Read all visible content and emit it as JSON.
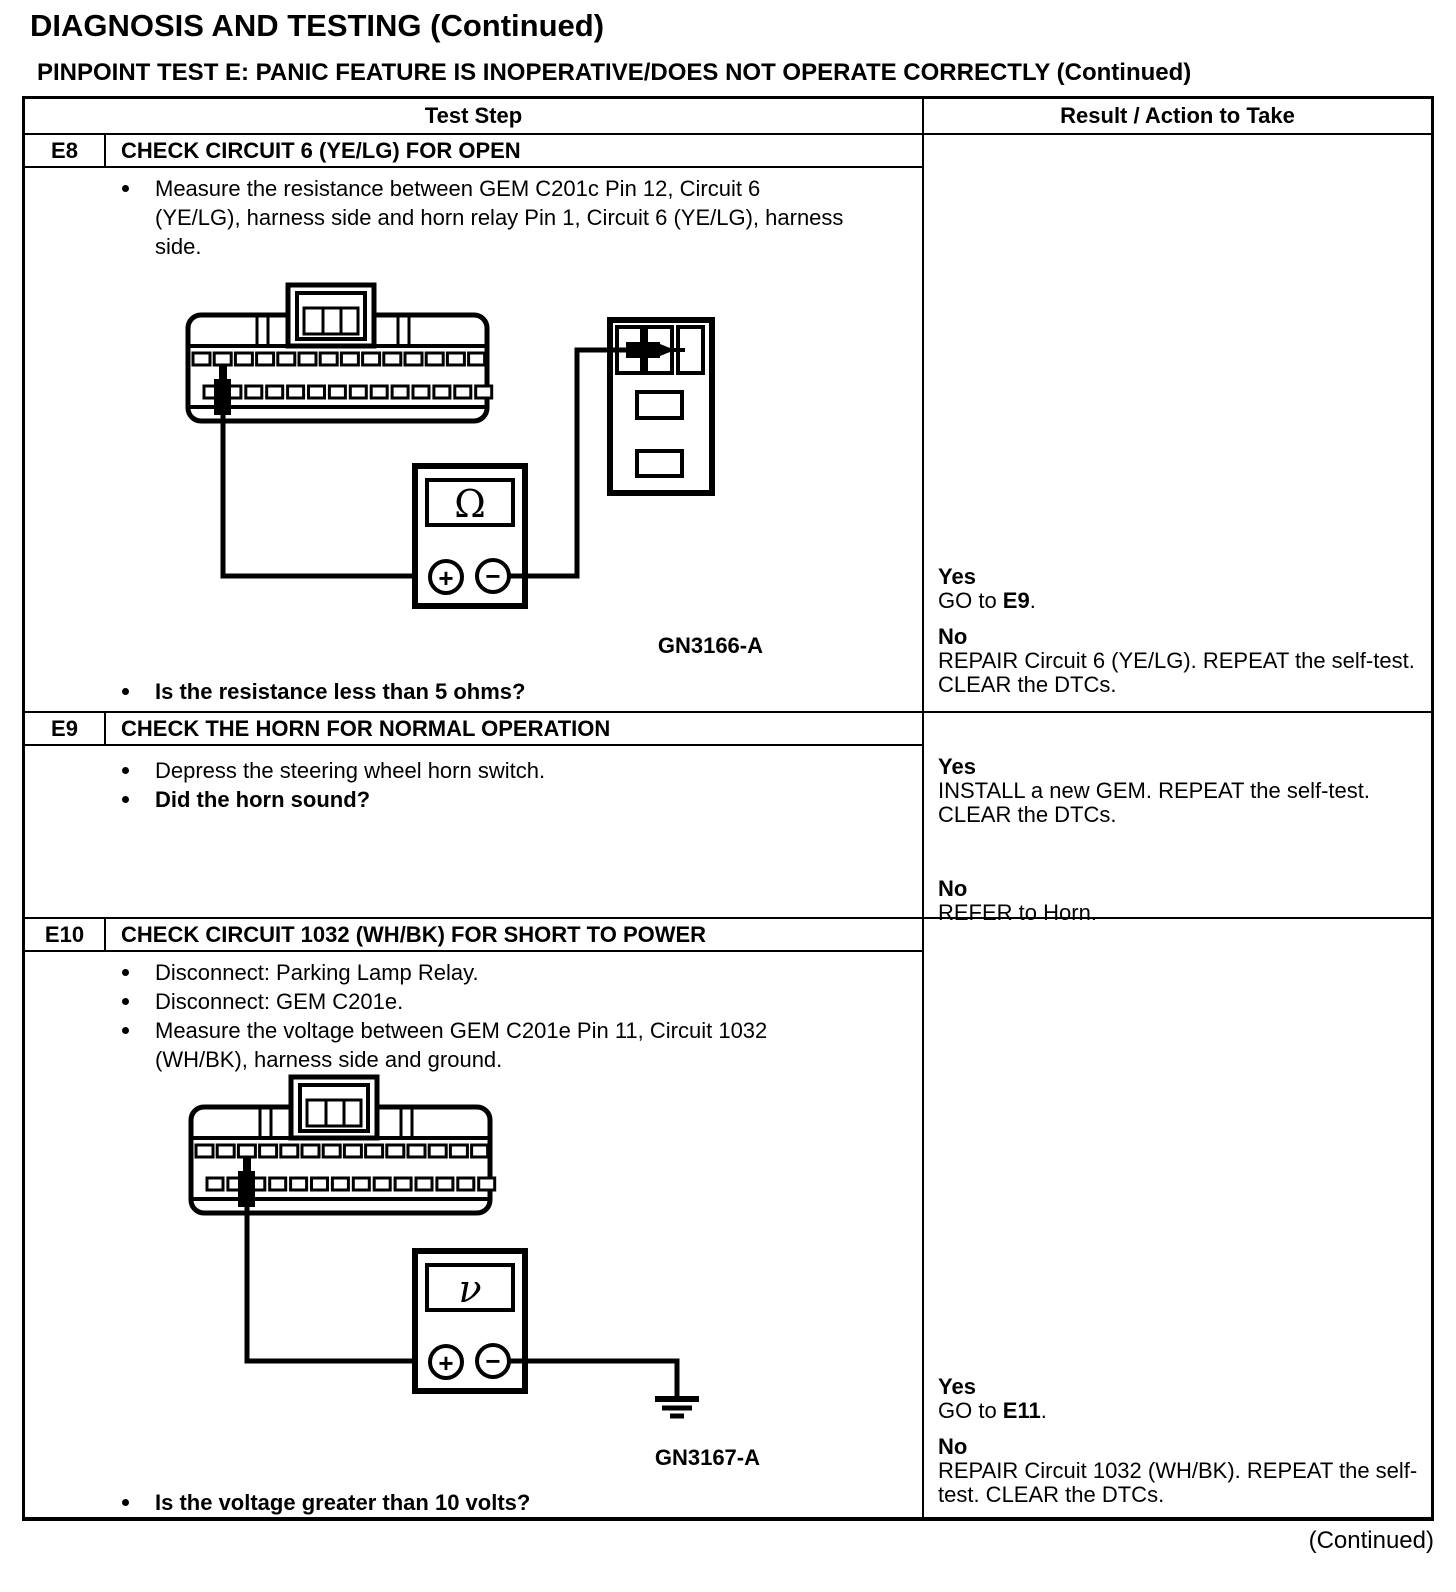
{
  "header": {
    "title": "DIAGNOSIS AND TESTING (Continued)",
    "subtitle": "PINPOINT TEST  E: PANIC FEATURE IS INOPERATIVE/DOES NOT OPERATE CORRECTLY (Continued)"
  },
  "table": {
    "columns": {
      "test_step": "Test Step",
      "result": "Result / Action to Take"
    }
  },
  "tests": {
    "e8": {
      "id": "E8",
      "title": "CHECK CIRCUIT 6 (YE/LG) FOR OPEN",
      "steps": {
        "s1": "Measure the resistance between GEM C201c Pin 12, Circuit 6 (YE/LG), harness side and horn relay Pin 1, Circuit 6 (YE/LG), harness side."
      },
      "question": "Is the resistance less than 5 ohms?",
      "figure": {
        "label": "GN3166-A",
        "meter_symbol": "Ω",
        "plus": "+",
        "minus": "−"
      },
      "result": {
        "yes_label": "Yes",
        "yes_prefix": "GO to ",
        "yes_link": "E9",
        "yes_suffix": ".",
        "no_label": "No",
        "no_action": "REPAIR Circuit 6 (YE/LG). REPEAT the self-test. CLEAR the DTCs."
      }
    },
    "e9": {
      "id": "E9",
      "title": "CHECK THE HORN FOR NORMAL OPERATION",
      "steps": {
        "s1": "Depress the steering wheel horn switch."
      },
      "question": "Did the horn sound?",
      "result": {
        "yes_label": "Yes",
        "yes_action": "INSTALL a new GEM. REPEAT the self-test. CLEAR the DTCs.",
        "no_label": "No",
        "no_action": "REFER to Horn."
      }
    },
    "e10": {
      "id": "E10",
      "title": "CHECK CIRCUIT 1032 (WH/BK) FOR SHORT TO POWER",
      "steps": {
        "s1": "Disconnect: Parking Lamp Relay.",
        "s2": "Disconnect: GEM C201e.",
        "s3": "Measure the voltage between GEM C201e Pin 11, Circuit 1032 (WH/BK), harness side and ground."
      },
      "question": "Is the voltage greater than 10 volts?",
      "figure": {
        "label": "GN3167-A",
        "meter_symbol": "ν",
        "plus": "+",
        "minus": "−"
      },
      "result": {
        "yes_label": "Yes",
        "yes_prefix": "GO to ",
        "yes_link": "E11",
        "yes_suffix": ".",
        "no_label": "No",
        "no_action": "REPAIR Circuit 1032 (WH/BK). REPEAT the self-test. CLEAR the DTCs."
      }
    }
  },
  "footer": {
    "continued": "(Continued)"
  }
}
